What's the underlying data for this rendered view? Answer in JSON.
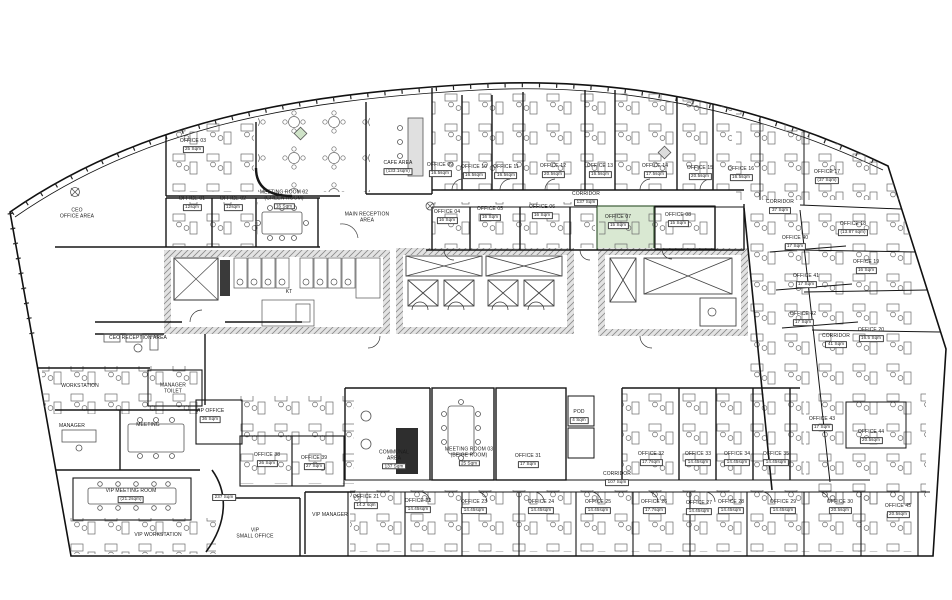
{
  "colors": {
    "wall": "#161616",
    "furniture": "#6b6b6b",
    "hatch_fill": "#e3e3e3",
    "highlight_fill": "#d9e8d2",
    "highlight_border": "#3d5c38",
    "dark_element": "#2e2e2e",
    "paper": "#ffffff"
  },
  "rooms": [
    {
      "label": "OFFICE 03",
      "area": "25 Sqm",
      "x": 193,
      "y": 146
    },
    {
      "label": "CEO\nOFFICE AREA",
      "x": 77,
      "y": 214
    },
    {
      "label": "CAFE AREA",
      "area": "(133.1sqm)",
      "x": 398,
      "y": 168
    },
    {
      "label": "OFFICE 01",
      "area": "12sqm",
      "x": 192,
      "y": 204
    },
    {
      "label": "OFFICE 02",
      "area": "12sqm",
      "x": 233,
      "y": 204
    },
    {
      "label": "MEETING ROOM 02\n(GREEN ROOM)",
      "area": "16 Sqm",
      "x": 284,
      "y": 200
    },
    {
      "label": "MAIN RECEPTION\nAREA",
      "x": 367,
      "y": 218
    },
    {
      "label": "OFFICE 09",
      "area": "16.5sqm",
      "x": 440,
      "y": 170
    },
    {
      "label": "OFFICE 10",
      "area": "16.5sqm",
      "x": 474,
      "y": 172
    },
    {
      "label": "OFFICE 11",
      "area": "16.5sqm",
      "x": 506,
      "y": 172
    },
    {
      "label": "OFFICE 12",
      "area": "20.5sqm",
      "x": 553,
      "y": 171
    },
    {
      "label": "OFFICE 13",
      "area": "16.5sqm",
      "x": 600,
      "y": 171
    },
    {
      "label": "OFFICE 14",
      "area": "17.5sqm",
      "x": 655,
      "y": 171
    },
    {
      "label": "OFFICE 15",
      "area": "20.5sqm",
      "x": 700,
      "y": 173
    },
    {
      "label": "OFFICE 16",
      "area": "16.5sqm",
      "x": 741,
      "y": 174
    },
    {
      "label": "OFFICE 17",
      "area": "(37 Sqm)",
      "x": 827,
      "y": 177
    },
    {
      "label": "CORRIDOR",
      "area": "137 Sqm",
      "x": 586,
      "y": 199
    },
    {
      "label": "CORRIDOR",
      "area": "37 Sqm",
      "x": 780,
      "y": 207
    },
    {
      "label": "OFFICE 04",
      "area": "16 Sqm",
      "x": 447,
      "y": 217
    },
    {
      "label": "OFFICE 05",
      "area": "16 Sqm",
      "x": 490,
      "y": 214
    },
    {
      "label": "OFFICE 06",
      "area": "16 Sqm",
      "x": 542,
      "y": 212
    },
    {
      "label": "OFFICE 07",
      "area": "15 Sqm",
      "x": 618,
      "y": 222
    },
    {
      "label": "OFFICE 08",
      "area": "15 Sqm",
      "x": 678,
      "y": 220
    },
    {
      "label": "OFFICE 40",
      "area": "17 Sqm",
      "x": 795,
      "y": 243
    },
    {
      "label": "OFFICE 41",
      "area": "17 Sqm",
      "x": 806,
      "y": 281
    },
    {
      "label": "OFFICE 42",
      "area": "17 Sqm",
      "x": 803,
      "y": 319
    },
    {
      "label": "OFFICE 18",
      "area": "(13.87 sqm)",
      "x": 853,
      "y": 229
    },
    {
      "label": "OFFICE 19",
      "area": "16 Sqm",
      "x": 866,
      "y": 267
    },
    {
      "label": "OFFICE 20",
      "area": "16.5 Sqm",
      "x": 871,
      "y": 335
    },
    {
      "label": "CORRIDOR",
      "area": "41 Sqm",
      "x": 836,
      "y": 341
    },
    {
      "label": "KT",
      "x": 289,
      "y": 293
    },
    {
      "label": "CEO RECEPTION AREA",
      "x": 138,
      "y": 339
    },
    {
      "label": "WORKSTATION",
      "x": 80,
      "y": 387
    },
    {
      "label": "MANAGER\nTOILET",
      "x": 173,
      "y": 389
    },
    {
      "label": "MANAGER",
      "x": 72,
      "y": 427
    },
    {
      "label": "MEETING",
      "x": 148,
      "y": 426
    },
    {
      "label": "VIP OFFICE",
      "area": "36 Sqm",
      "x": 210,
      "y": 416
    },
    {
      "label": "OFFICE 38",
      "area": "26 Sqm",
      "x": 267,
      "y": 460
    },
    {
      "label": "OFFICE 39",
      "area": "27 Sqm",
      "x": 314,
      "y": 463
    },
    {
      "label": "VIP MEETING ROOM",
      "area": "(21.2sqm)",
      "x": 131,
      "y": 496
    },
    {
      "label": "",
      "area": "237 Sqm",
      "x": 224,
      "y": 497
    },
    {
      "label": "VIP WORKSTATION",
      "x": 158,
      "y": 536
    },
    {
      "label": "VIP\nSMALL OFFICE",
      "x": 255,
      "y": 534
    },
    {
      "label": "VIP MANAGER",
      "x": 330,
      "y": 516
    },
    {
      "label": "COMMUNAL\nAREA",
      "area": "137 Sqm",
      "x": 394,
      "y": 460
    },
    {
      "label": "MEETING ROOM 03\n(BEIGE ROOM)",
      "area": "25 Sqm",
      "x": 469,
      "y": 457
    },
    {
      "label": "OFFICE 31",
      "area": "17 Sqm",
      "x": 528,
      "y": 461
    },
    {
      "label": "POD",
      "area": "4 Sqm",
      "x": 579,
      "y": 417
    },
    {
      "label": "CORRIDOR",
      "area": "107 Sqm",
      "x": 617,
      "y": 479
    },
    {
      "label": "OFFICE 32",
      "area": "17.7sqm",
      "x": 651,
      "y": 459
    },
    {
      "label": "OFFICE 33",
      "area": "14.45sqm",
      "x": 698,
      "y": 459
    },
    {
      "label": "OFFICE 34",
      "area": "14.45sqm",
      "x": 737,
      "y": 459
    },
    {
      "label": "OFFICE 35",
      "area": "14.45sqm",
      "x": 776,
      "y": 459
    },
    {
      "label": "OFFICE 43",
      "area": "17 Sqm",
      "x": 822,
      "y": 424
    },
    {
      "label": "OFFICE 44",
      "area": "20.5sqm",
      "x": 871,
      "y": 437
    },
    {
      "label": "OFFICE 21",
      "area": "14.2 sqm",
      "x": 366,
      "y": 502
    },
    {
      "label": "OFFICE 22",
      "area": "14.45sqm",
      "x": 418,
      "y": 506
    },
    {
      "label": "OFFICE 23",
      "area": "14.45sqm",
      "x": 474,
      "y": 507
    },
    {
      "label": "OFFICE 24",
      "area": "14.45sqm",
      "x": 541,
      "y": 507
    },
    {
      "label": "OFFICE 25",
      "area": "14.45sqm",
      "x": 598,
      "y": 507
    },
    {
      "label": "OFFICE 26",
      "area": "17.7sqm",
      "x": 654,
      "y": 507
    },
    {
      "label": "OFFICE 27",
      "area": "14.45sqm",
      "x": 699,
      "y": 508
    },
    {
      "label": "OFFICE 28",
      "area": "14.45sqm",
      "x": 731,
      "y": 507
    },
    {
      "label": "OFFICE 29",
      "area": "14.45sqm",
      "x": 783,
      "y": 507
    },
    {
      "label": "OFFICE 30",
      "area": "20.5sqm",
      "x": 840,
      "y": 507
    },
    {
      "label": "OFFICE 45",
      "area": "20.5sqm",
      "x": 898,
      "y": 511
    }
  ]
}
